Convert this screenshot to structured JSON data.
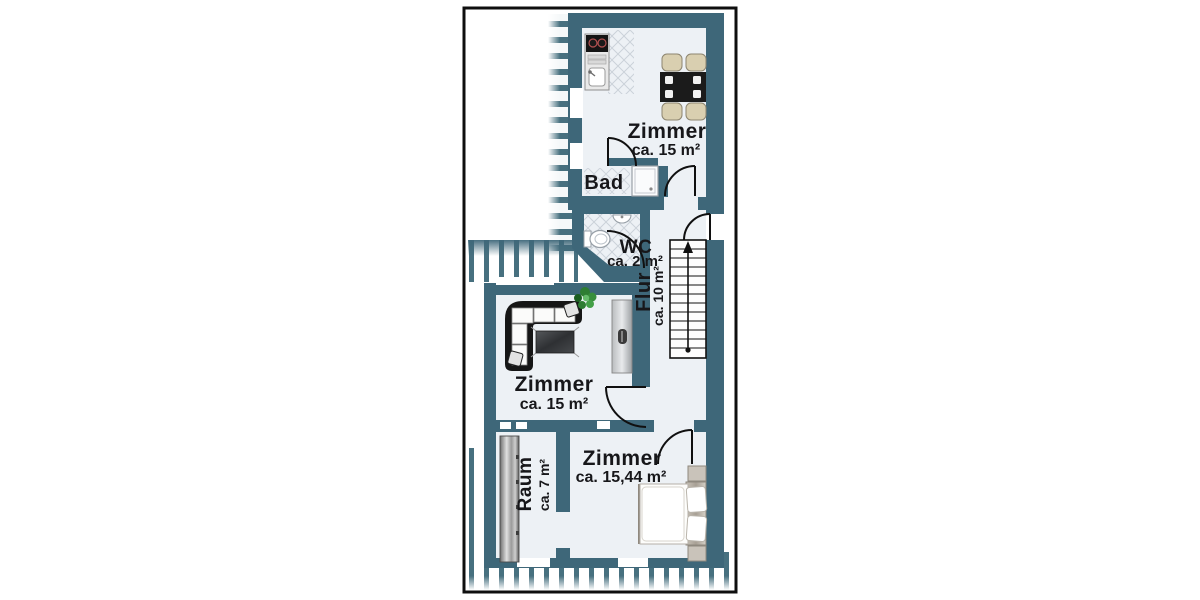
{
  "plan": {
    "title": "floor-plan",
    "rooms": {
      "top_room": {
        "label": "Zimmer",
        "area": "ca. 15 m²"
      },
      "bath": {
        "label": "Bad"
      },
      "wc": {
        "label": "WC",
        "area": "ca. 2 m²"
      },
      "hallway": {
        "label": "Flur",
        "area": "ca. 10 m²"
      },
      "living_room": {
        "label": "Zimmer",
        "area": "ca. 15 m²"
      },
      "bedroom": {
        "label": "Zimmer",
        "area": "ca. 15,44 m²"
      },
      "storage": {
        "label": "Raum",
        "area": "ca. 7 m²"
      }
    },
    "stairs": {
      "direction": "up"
    },
    "colors": {
      "wall": "#3e6779",
      "floor": "#edf1f5",
      "hatch": "#47707f",
      "outline": "#111111",
      "background": "#ffffff",
      "furniture_dark": "#1a1a1a",
      "chair_beige": "#d9cfb0"
    }
  }
}
